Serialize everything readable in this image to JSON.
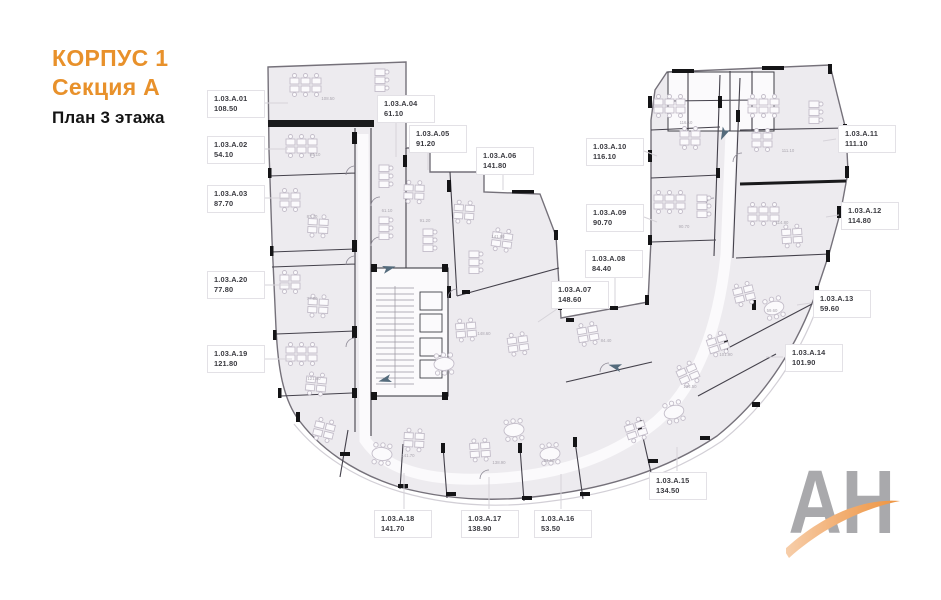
{
  "title": {
    "corpus": "КОРПУС 1",
    "section": "Секция А",
    "floor": "План 3 этажа"
  },
  "plan": {
    "rooms": [
      {
        "num": "1.03.А.01",
        "area": "108.50"
      },
      {
        "num": "1.03.А.02",
        "area": "54.10"
      },
      {
        "num": "1.03.А.03",
        "area": "87.70"
      },
      {
        "num": "1.03.А.04",
        "area": "61.10"
      },
      {
        "num": "1.03.А.05",
        "area": "91.20"
      },
      {
        "num": "1.03.А.06",
        "area": "141.80"
      },
      {
        "num": "1.03.А.07",
        "area": "148.60"
      },
      {
        "num": "1.03.А.08",
        "area": "84.40"
      },
      {
        "num": "1.03.А.09",
        "area": "90.70"
      },
      {
        "num": "1.03.А.10",
        "area": "116.10"
      },
      {
        "num": "1.03.А.11",
        "area": "111.10"
      },
      {
        "num": "1.03.А.12",
        "area": "114.80"
      },
      {
        "num": "1.03.А.13",
        "area": "59.60"
      },
      {
        "num": "1.03.А.14",
        "area": "101.90"
      },
      {
        "num": "1.03.А.15",
        "area": "134.50"
      },
      {
        "num": "1.03.А.16",
        "area": "53.50"
      },
      {
        "num": "1.03.А.17",
        "area": "138.90"
      },
      {
        "num": "1.03.А.18",
        "area": "141.70"
      },
      {
        "num": "1.03.А.19",
        "area": "121.80"
      },
      {
        "num": "1.03.А.20",
        "area": "77.80"
      }
    ]
  },
  "logo": {
    "text": "АН"
  },
  "colors": {
    "accent_orange": "#E8912B",
    "room_fill": "#EDEBEF",
    "wall_dark": "#3F3F46",
    "wall_black": "#1A1A1C",
    "label_text": "#3A3A40",
    "leader_gray": "#D6D3D9",
    "logo_gray": "#A9A9AC",
    "logo_orange": "#ED9440"
  }
}
